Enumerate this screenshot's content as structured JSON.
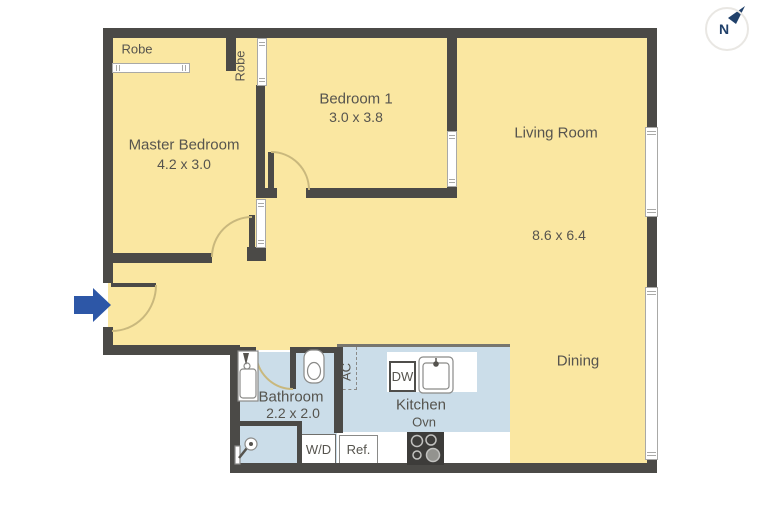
{
  "compass": {
    "label": "N"
  },
  "rooms": {
    "master_bedroom": {
      "name": "Master Bedroom",
      "dims": "4.2 x 3.0",
      "robe": "Robe"
    },
    "bedroom1": {
      "name": "Bedroom 1",
      "dims": "3.0 x 3.8",
      "robe": "Robe"
    },
    "living": {
      "name": "Living Room",
      "dims": "8.6 x 6.4"
    },
    "dining": {
      "name": "Dining"
    },
    "bathroom": {
      "name": "Bathroom",
      "dims": "2.2 x 2.0"
    },
    "kitchen": {
      "name": "Kitchen"
    }
  },
  "fixtures": {
    "dishwasher": "DW",
    "oven": "Ovn",
    "fridge": "Ref.",
    "washer_dryer": "W/D",
    "air_conditioner": "AC"
  },
  "colors": {
    "floor": "#FAE7A1",
    "wet_floor": "#CBDDE9",
    "wall": "#4B4A47",
    "door_arc": "#C9B87D",
    "entry_arrow": "#2D57A7",
    "compass_navy": "#20406A",
    "label_text": "#56544E"
  }
}
